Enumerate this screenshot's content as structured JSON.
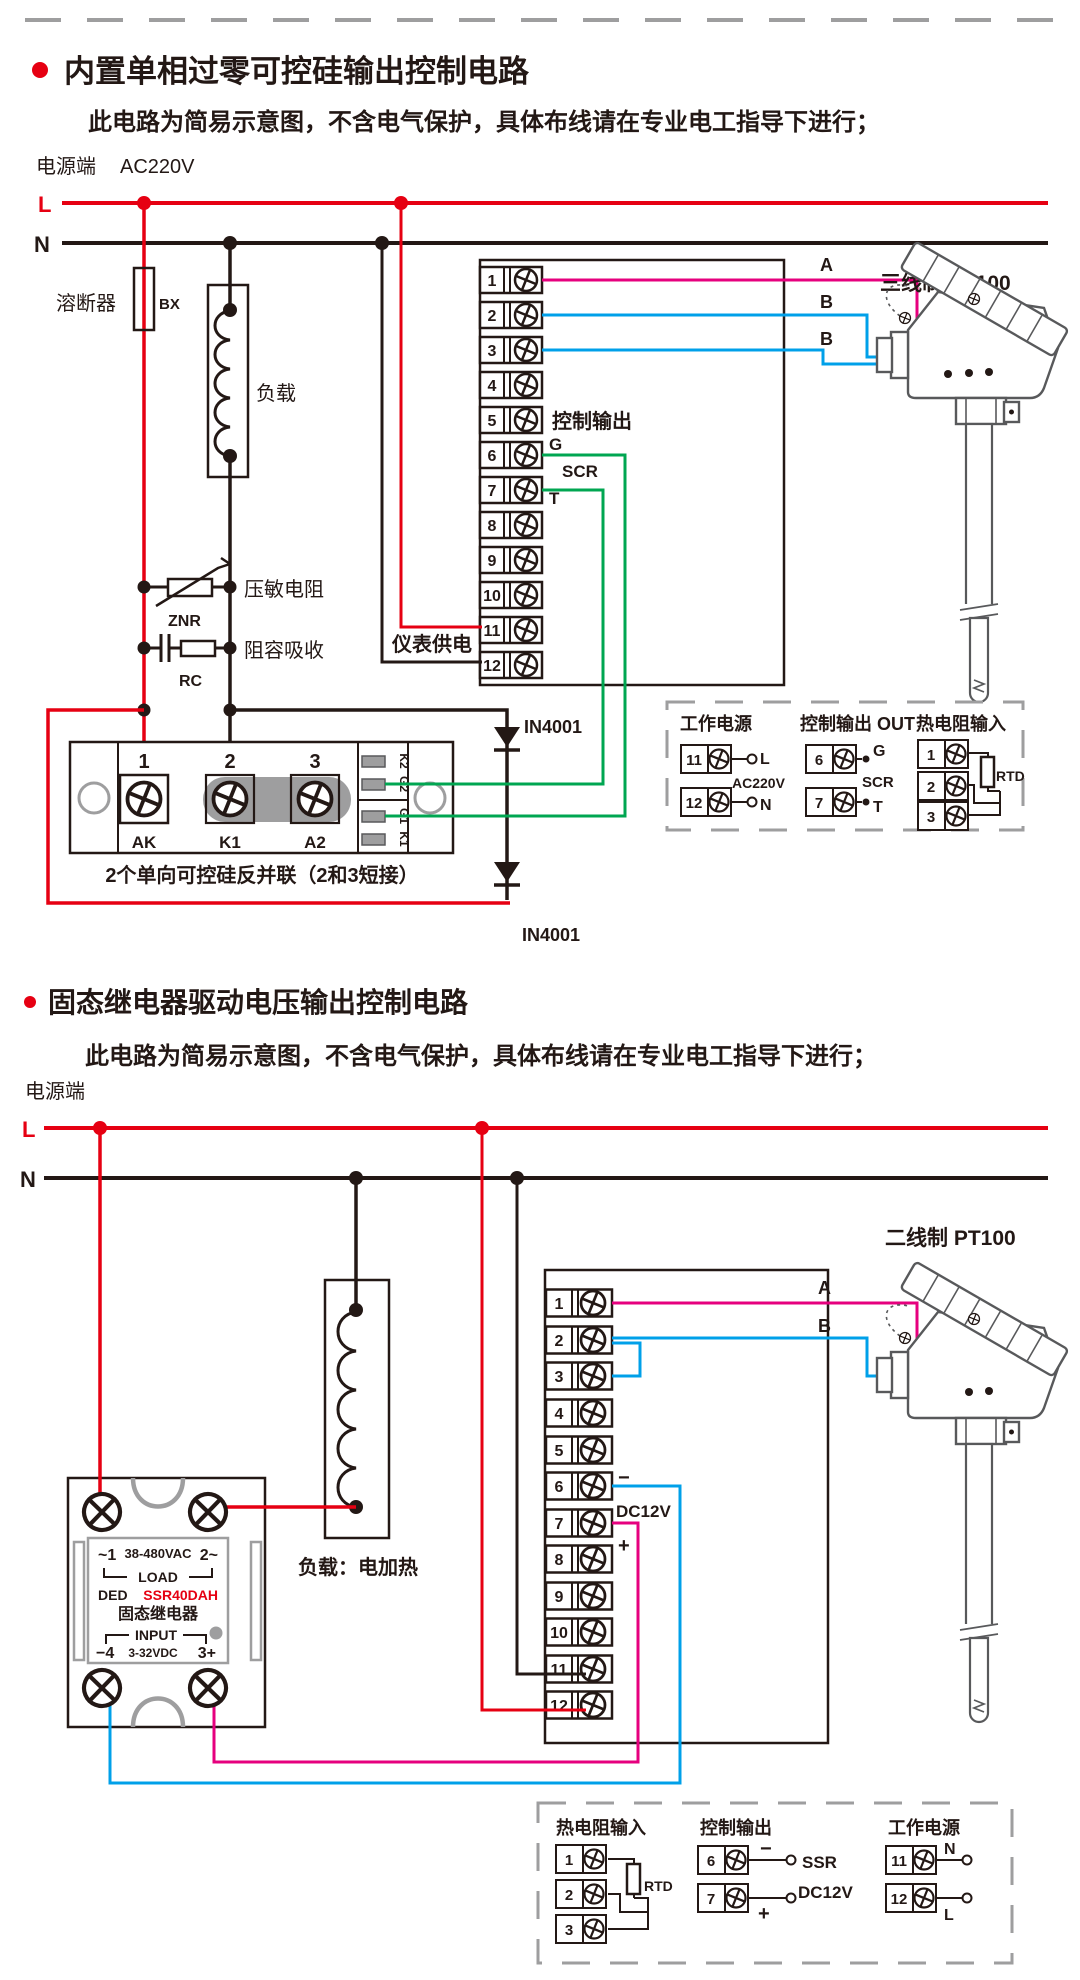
{
  "colors": {
    "red": "#e60012",
    "magenta": "#e6007e",
    "blue": "#00a0e9",
    "green": "#00a651",
    "black": "#231815",
    "gray": "#9e9e9f"
  },
  "terminal_numbers": [
    "1",
    "2",
    "3",
    "4",
    "5",
    "6",
    "7",
    "8",
    "9",
    "10",
    "11",
    "12"
  ],
  "section1": {
    "title": "内置单相过零可控硅输出控制电路",
    "subtitle": "此电路为简易示意图，不含电气保护，具体布线请在专业电工指导下进行；",
    "power_terminal_label": "电源端",
    "voltage": "AC220V",
    "line_live": "L",
    "line_neutral": "N",
    "fuse_label": "溶断器",
    "fuse_code": "BX",
    "load_label": "负载",
    "varistor_label": "压敏电阻",
    "varistor_code": "ZNR",
    "rc_label": "阻容吸收",
    "rc_code": "RC",
    "meter_supply_label": "仪表供电",
    "control_output_label": "控制输出",
    "gate_label": "G",
    "scr_label": "SCR",
    "t_label": "T",
    "diode_label_1": "IN4001",
    "diode_label_2": "IN4001",
    "wire_a": "A",
    "wire_b1": "B",
    "wire_b2": "B",
    "sensor_label": "三线制 PT100",
    "module": {
      "n1": "1",
      "n2": "2",
      "n3": "3",
      "p1": "AK",
      "p2": "K1",
      "p3": "A2",
      "s1": "K2",
      "s2": "G2",
      "s3": "G1",
      "s4": "K1",
      "caption": "2个单向可控硅反并联（2和3短接）"
    },
    "legend": {
      "power": {
        "title": "工作电源",
        "t1": "11",
        "t2": "12",
        "l": "L",
        "n": "N",
        "volt": "AC220V"
      },
      "output": {
        "title": "控制输出 OUT",
        "t1": "6",
        "t2": "7",
        "g": "G",
        "t": "T",
        "scr": "SCR"
      },
      "rtd": {
        "title": "热电阻输入",
        "t1": "1",
        "t2": "2",
        "t3": "3",
        "rtd": "RTD"
      }
    }
  },
  "section2": {
    "title": "固态继电器驱动电压输出控制电路",
    "subtitle": "此电路为简易示意图，不含电气保护，具体布线请在专业电工指导下进行；",
    "power_terminal_label": "电源端",
    "line_live": "L",
    "line_neutral": "N",
    "load_label": "负载：电加热",
    "sensor_label": "二线制 PT100",
    "wire_a": "A",
    "wire_b": "B",
    "minus": "−",
    "plus": "+",
    "dc12v": "DC12V",
    "ssr": {
      "load_left": "~1",
      "load_voltage": "38-480VAC",
      "load_right": "2~",
      "load_text": "LOAD",
      "brand": "DED",
      "model": "SSR40DAH",
      "name": "固态继电器",
      "input_text": "INPUT",
      "input_left": "−4",
      "input_voltage": "3-32VDC",
      "input_right": "3+"
    },
    "legend": {
      "rtd": {
        "title": "热电阻输入",
        "t1": "1",
        "t2": "2",
        "t3": "3",
        "rtd": "RTD"
      },
      "output": {
        "title": "控制输出",
        "t1": "6",
        "t2": "7",
        "minus": "−",
        "plus": "+",
        "ssr": "SSR",
        "dc12v": "DC12V"
      },
      "power": {
        "title": "工作电源",
        "t1": "11",
        "t2": "12",
        "n": "N",
        "l": "L"
      }
    }
  }
}
